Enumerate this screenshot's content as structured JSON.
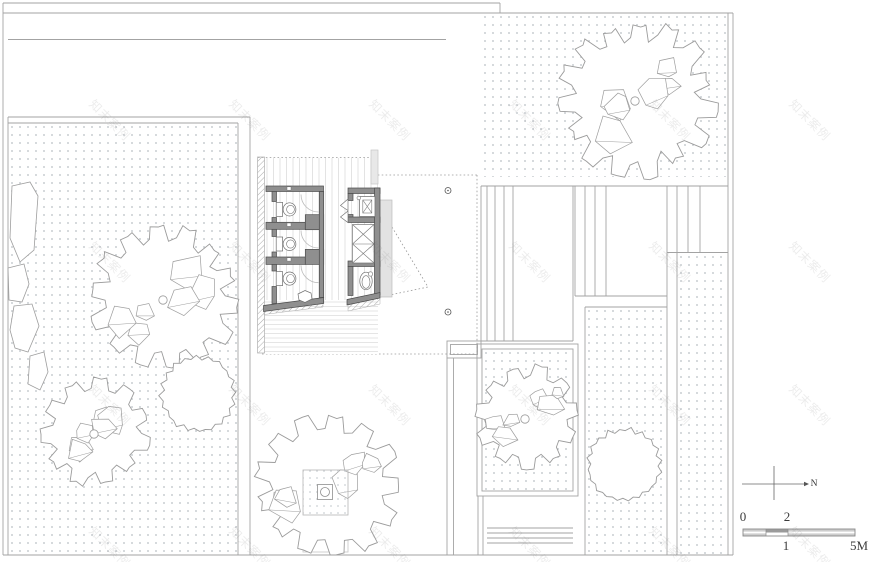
{
  "watermark": {
    "text": "知末案例"
  },
  "scale_bar": {
    "tick_0": "0",
    "tick_2": "2",
    "tick_1": "1",
    "tick_5m": "5M"
  },
  "compass": {
    "north": "N"
  },
  "drawing": {
    "colors": {
      "line": "#a3a3a3",
      "boundary": "#9a9a9a",
      "wall_fill": "#8f8f8f",
      "wall_edge": "#4a4a4a",
      "dash": "#9a9a9a",
      "fixture": "#6e6e6e",
      "tree_stroke": "#9b9b9b",
      "rock_stroke": "#9e9e9e",
      "stipple_dot": "#ccd0d4",
      "deck_stripe": "#e3e3e3",
      "hatch": "#ababab",
      "scale_light": "#cdcdcd",
      "scale_dark": "#9b9b9b",
      "text": "#3c3c3c"
    },
    "trees": [
      {
        "id": "garden-tree-large",
        "cx": 165,
        "cy": 298,
        "r": 76,
        "style": "jagged",
        "seed": 11,
        "trunk": true,
        "rocks": [
          [
            -30,
            18
          ],
          [
            22,
            -8
          ]
        ]
      },
      {
        "id": "garden-tree-small",
        "cx": 96,
        "cy": 432,
        "r": 55,
        "style": "jagged",
        "seed": 23,
        "trunk": true,
        "rocks": [
          [
            -18,
            8
          ],
          [
            14,
            -16
          ]
        ]
      },
      {
        "id": "garden-tree-round",
        "cx": 198,
        "cy": 394,
        "r": 39,
        "style": "wavy",
        "seed": 37,
        "trunk": false,
        "rocks": []
      },
      {
        "id": "plaza-tree",
        "cx": 328,
        "cy": 486,
        "r": 74,
        "style": "jagged",
        "seed": 41,
        "trunk": false,
        "rocks": [
          [
            -36,
            8
          ],
          [
            26,
            -12
          ]
        ]
      },
      {
        "id": "northeast-tree",
        "cx": 637,
        "cy": 99,
        "r": 81,
        "style": "jagged",
        "seed": 53,
        "trunk": true,
        "rocks": [
          [
            -26,
            20
          ],
          [
            32,
            -22
          ]
        ]
      },
      {
        "id": "courtyard-tree",
        "cx": 527,
        "cy": 417,
        "r": 54,
        "style": "jagged",
        "seed": 67,
        "trunk": true,
        "rocks": [
          [
            -24,
            12
          ],
          [
            20,
            -18
          ]
        ]
      },
      {
        "id": "east-tree-round",
        "cx": 624,
        "cy": 465,
        "r": 38,
        "style": "wavy",
        "seed": 79,
        "trunk": false,
        "rocks": []
      }
    ]
  }
}
